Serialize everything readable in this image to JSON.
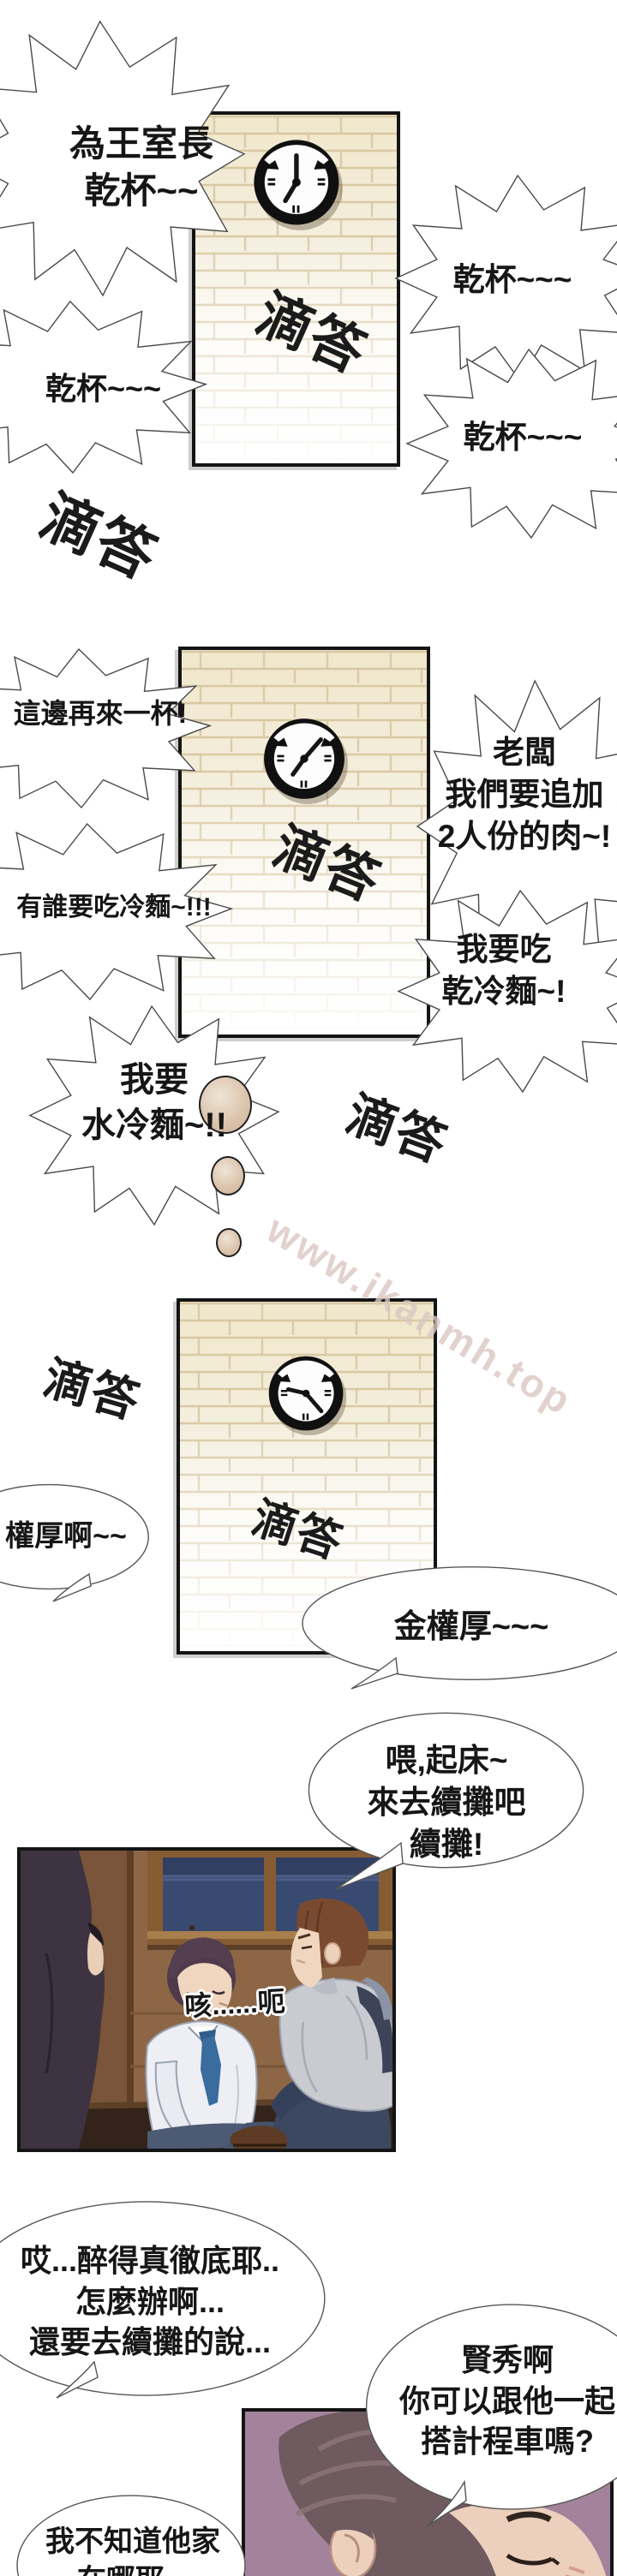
{
  "watermark": "www.ikanmh.top",
  "sfx": {
    "tick": "滴答"
  },
  "bubbles": {
    "toast_leader": "為王室長\n乾杯~~",
    "cheers_1": "乾杯~~~",
    "cheers_2": "乾杯~~~",
    "cheers_3": "乾杯~~~",
    "another_round": "這邊再來一杯!",
    "boss_more_meat": "老闆\n我們要追加\n2人份的肉~!",
    "who_cold_noodles": "有誰要吃冷麵~!!!",
    "dry_cold_noodles": "我要吃\n乾冷麵~!",
    "water_cold_noodles": "我要\n水冷麵~!!",
    "kwonhoo_ah": "權厚啊~~",
    "kim_kwonhoo": "金權厚~~~",
    "wake_up": "喂,起床~\n來去續攤吧\n續攤!",
    "cough": "咳......呃",
    "so_drunk": "哎...醉得真徹底耶..\n怎麼辦啊...\n還要去續攤的說...",
    "hyunsoo_taxi": "賢秀啊\n你可以跟他一起\n搭計程車嗎?",
    "dont_know_home": "我不知道他家\n在哪耶..."
  }
}
